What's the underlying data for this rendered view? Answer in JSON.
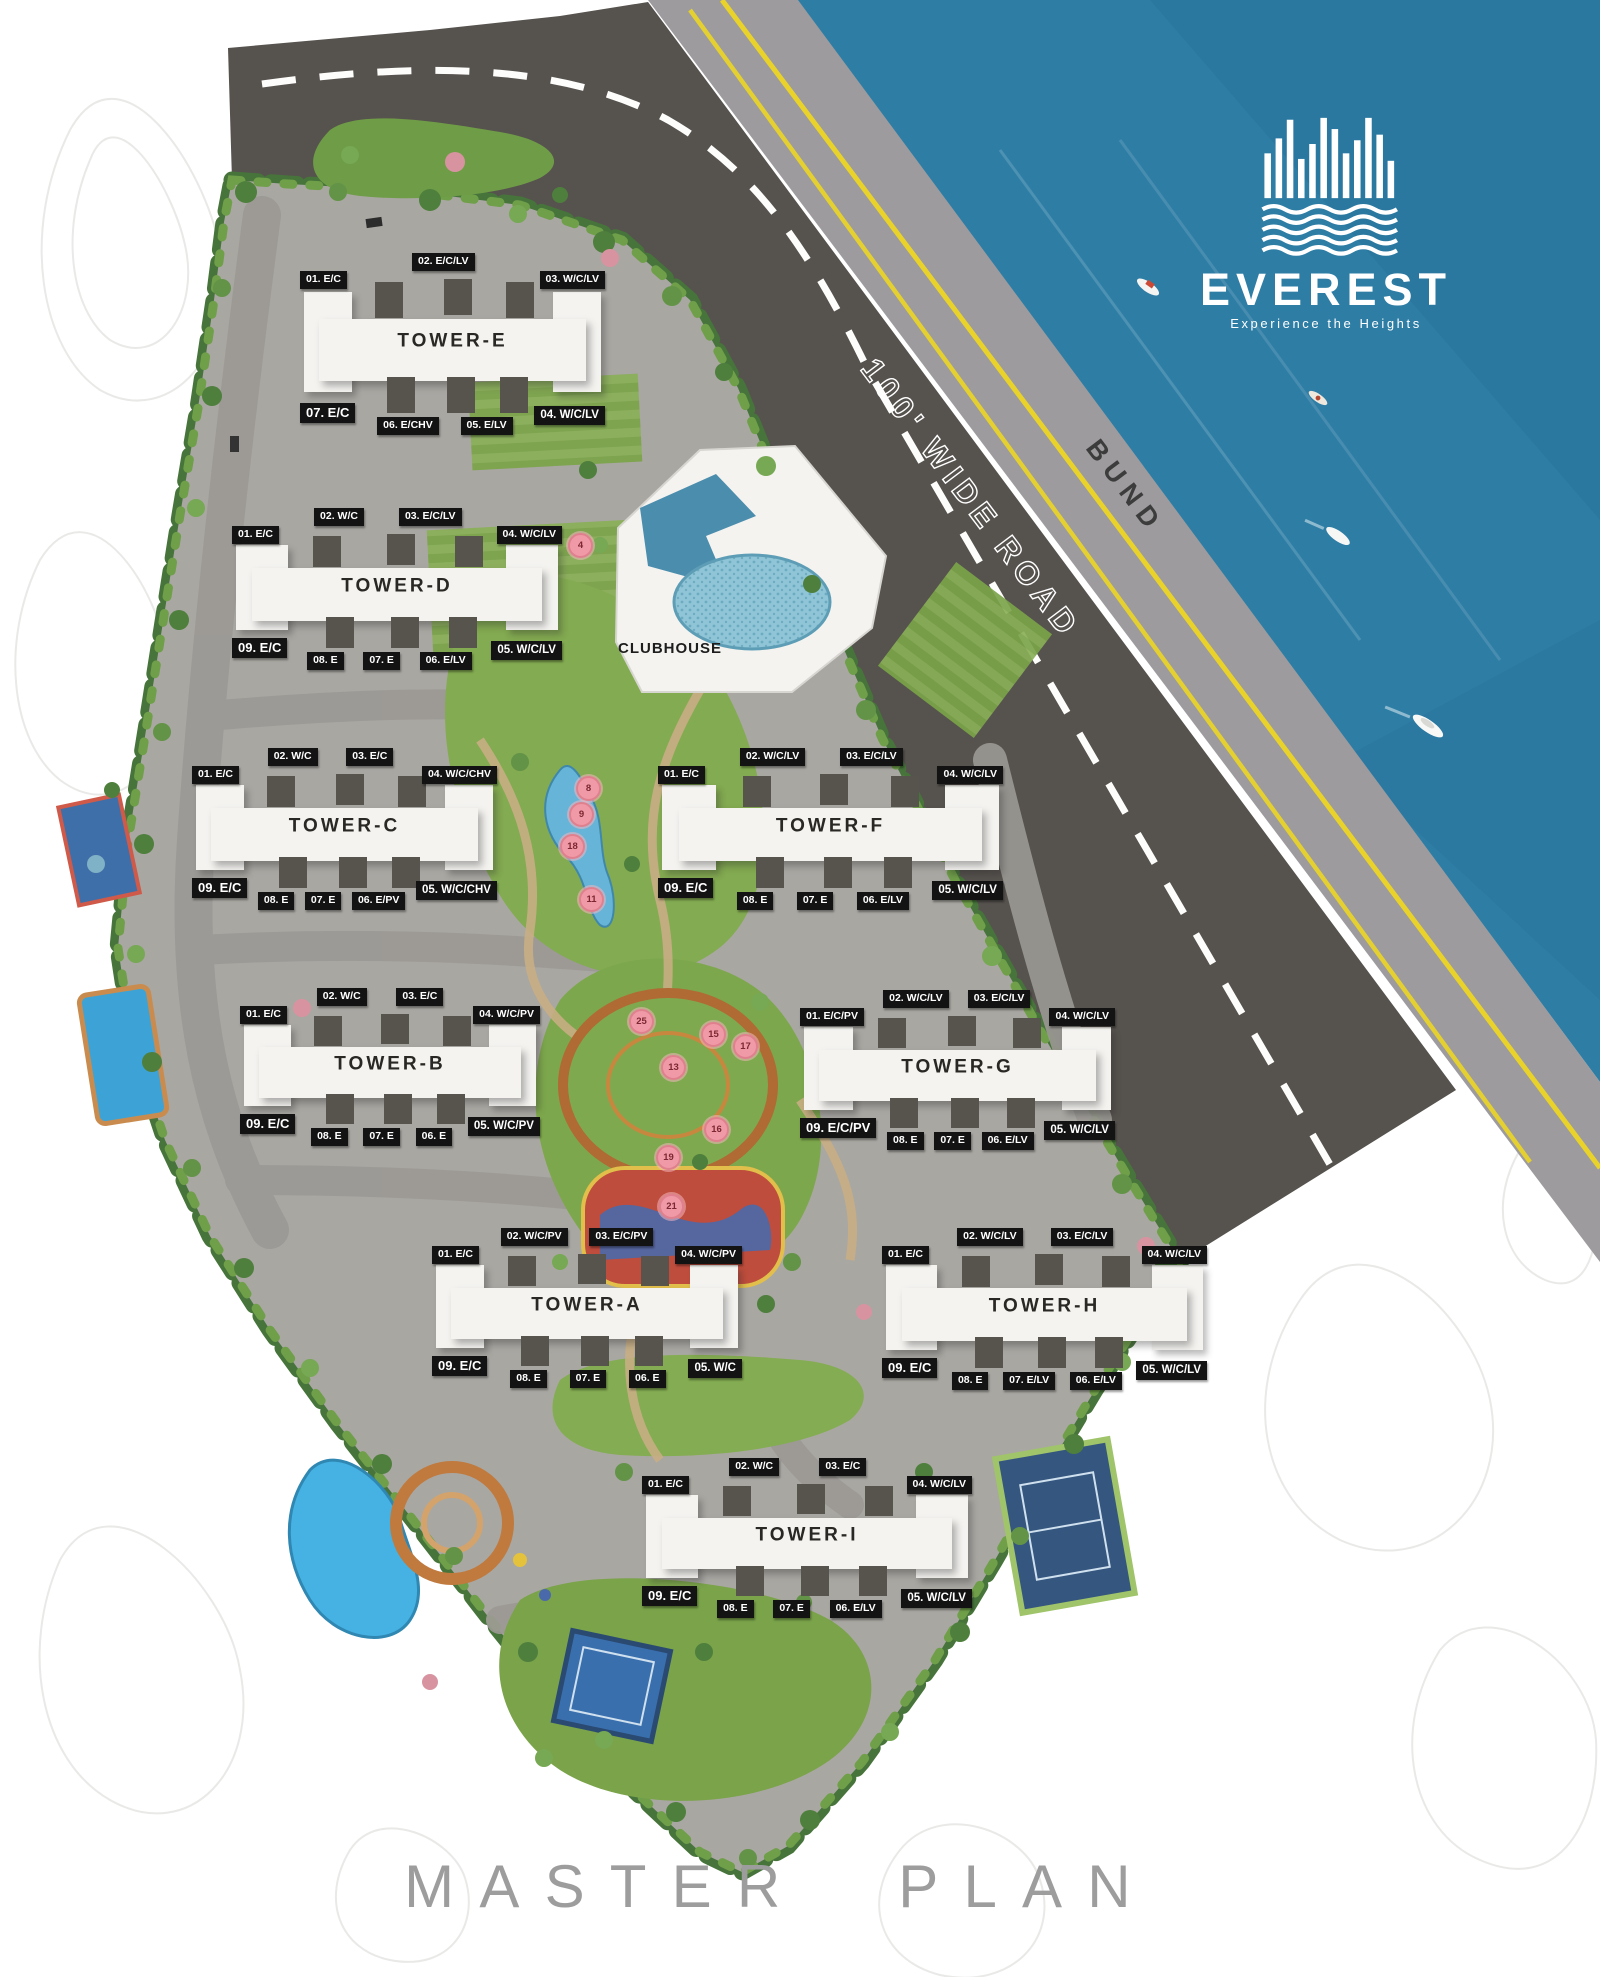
{
  "page": {
    "title": "MASTER PLAN"
  },
  "branding": {
    "name": "EVEREST",
    "tagline": "Experience the Heights"
  },
  "labels": {
    "road": "100' WIDE ROAD",
    "bund": "BUND",
    "clubhouse": "CLUBHOUSE"
  },
  "colors": {
    "water": "#2e7da5",
    "road": "#56524e",
    "bund": "#9d9b9d",
    "ground": "#a9a7a2",
    "lawn": "#84ac52",
    "border_green": "#4a7a3b",
    "accent_yellow": "#e9d32b",
    "chip_bg": "#131313",
    "marker_pink": "#ef9aa6",
    "title_gray": "#9d9d9d"
  },
  "towers": [
    {
      "name": "TOWER-E",
      "top_units": [
        "01.  E/C",
        "02. E/C/LV",
        "03. W/C/LV"
      ],
      "bottom_units": [
        "07.  E/C",
        "06. E/CHV",
        "05. E/LV",
        "04. W/C/LV"
      ]
    },
    {
      "name": "TOWER-D",
      "top_units": [
        "01.  E/C",
        "02. W/C",
        "03. E/C/LV",
        "04. W/C/LV"
      ],
      "bottom_units": [
        "09.  E/C",
        "08. E",
        "07. E",
        "06. E/LV",
        "05. W/C/LV"
      ]
    },
    {
      "name": "TOWER-C",
      "top_units": [
        "01.  E/C",
        "02. W/C",
        "03. E/C",
        "04. W/C/CHV"
      ],
      "bottom_units": [
        "09.  E/C",
        "08. E",
        "07. E",
        "06. E/PV",
        "05. W/C/CHV"
      ]
    },
    {
      "name": "TOWER-F",
      "top_units": [
        "01.  E/C",
        "02. W/C/LV",
        "03. E/C/LV",
        "04. W/C/LV"
      ],
      "bottom_units": [
        "09.  E/C",
        "08. E",
        "07. E",
        "06. E/LV",
        "05. W/C/LV"
      ]
    },
    {
      "name": "TOWER-B",
      "top_units": [
        "01.  E/C",
        "02. W/C",
        "03. E/C",
        "04. W/C/PV"
      ],
      "bottom_units": [
        "09.  E/C",
        "08. E",
        "07. E",
        "06. E",
        "05. W/C/PV"
      ]
    },
    {
      "name": "TOWER-G",
      "top_units": [
        "01.  E/C/PV",
        "02. W/C/LV",
        "03. E/C/LV",
        "04. W/C/LV"
      ],
      "bottom_units": [
        "09.  E/C/PV",
        "08. E",
        "07. E",
        "06. E/LV",
        "05. W/C/LV"
      ]
    },
    {
      "name": "TOWER-A",
      "top_units": [
        "01.  E/C",
        "02. W/C/PV",
        "03. E/C/PV",
        "04. W/C/PV"
      ],
      "bottom_units": [
        "09.  E/C",
        "08. E",
        "07. E",
        "06. E",
        "05. W/C"
      ]
    },
    {
      "name": "TOWER-H",
      "top_units": [
        "01.  E/C",
        "02. W/C/LV",
        "03. E/C/LV",
        "04. W/C/LV"
      ],
      "bottom_units": [
        "09.  E/C",
        "08. E",
        "07. E/LV",
        "06. E/LV",
        "05. W/C/LV"
      ]
    },
    {
      "name": "TOWER-I",
      "top_units": [
        "01.  E/C",
        "02. W/C",
        "03. E/C",
        "04. W/C/LV"
      ],
      "bottom_units": [
        "09.  E/C",
        "08. E",
        "07. E",
        "06. E/LV",
        "05. W/C/LV"
      ]
    }
  ],
  "markers": [
    {
      "n": "4"
    },
    {
      "n": "8"
    },
    {
      "n": "9"
    },
    {
      "n": "18"
    },
    {
      "n": "11"
    },
    {
      "n": "25"
    },
    {
      "n": "15"
    },
    {
      "n": "17"
    },
    {
      "n": "13"
    },
    {
      "n": "16"
    },
    {
      "n": "19"
    },
    {
      "n": "21"
    }
  ]
}
